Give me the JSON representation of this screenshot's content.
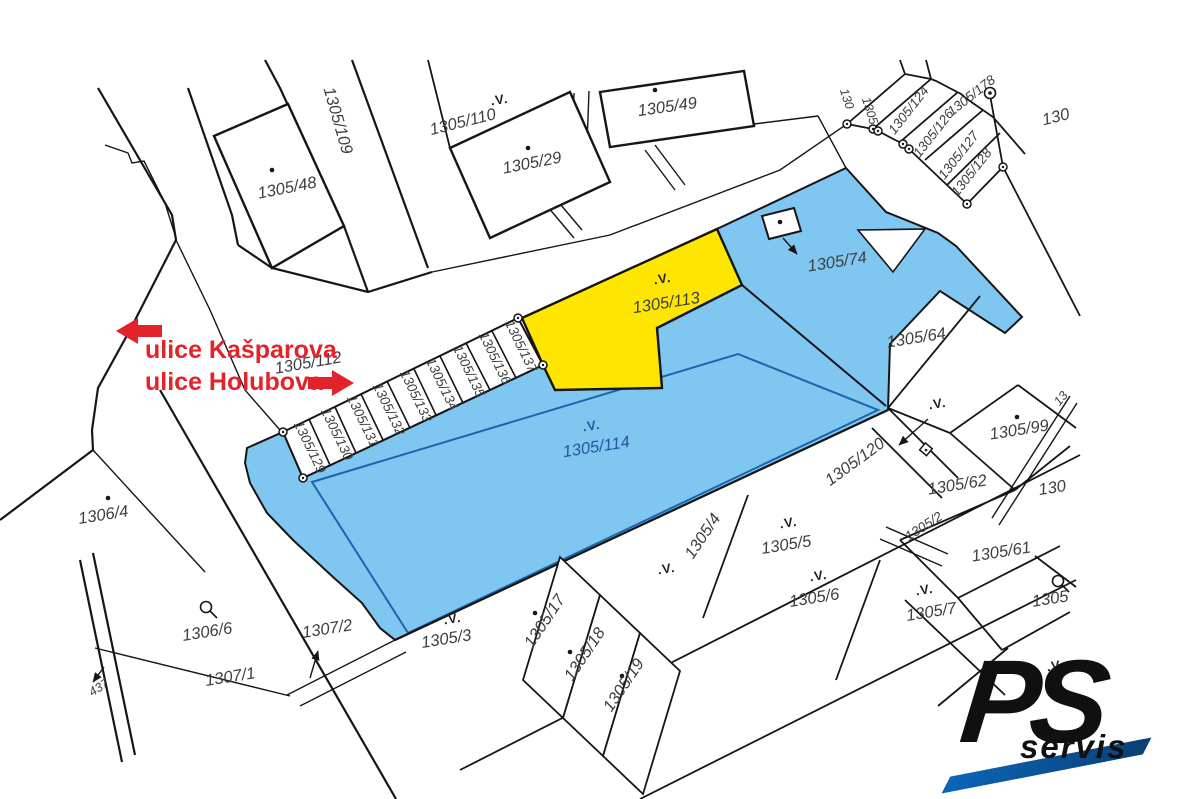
{
  "colors": {
    "parcel_blue": "#7fc6f1",
    "parcel_yellow": "#ffe600",
    "line": "#161616",
    "label": "#3f3f3f",
    "label_blue": "#2456a4",
    "red": "#e2242a",
    "logo_blue": "#0a66b8"
  },
  "street_annotations": {
    "kasparova": "ulice Kašparova",
    "holubova": "ulice Holubova"
  },
  "symbols": {
    "landuse": ".V."
  },
  "labels": [
    {
      "text": "1305/109"
    },
    {
      "text": "1305/110"
    },
    {
      "text": "1305/29"
    },
    {
      "text": "1305/49"
    },
    {
      "text": "1305/48"
    },
    {
      "text": "1305/112"
    },
    {
      "text": "1305/113"
    },
    {
      "text": "1305/74"
    },
    {
      "text": "1305/64"
    },
    {
      "text": "1305/114"
    },
    {
      "text": "1305/120"
    },
    {
      "text": "1305/99"
    },
    {
      "text": "1305/62"
    },
    {
      "text": "1305/61"
    },
    {
      "text": "1305/2"
    },
    {
      "text": "1306/4"
    },
    {
      "text": "1306/6"
    },
    {
      "text": "1307/2"
    },
    {
      "text": "1307/1"
    },
    {
      "text": "1305/3"
    },
    {
      "text": "1305/17"
    },
    {
      "text": "1305/18"
    },
    {
      "text": "1305/19"
    },
    {
      "text": "1305/4"
    },
    {
      "text": "1305/5"
    },
    {
      "text": "1305/6"
    },
    {
      "text": "1305/7"
    },
    {
      "text": "1305/129"
    },
    {
      "text": "1305/130"
    },
    {
      "text": "1305/131"
    },
    {
      "text": "1305/132"
    },
    {
      "text": "1305/133"
    },
    {
      "text": "1305/134"
    },
    {
      "text": "1305/135"
    },
    {
      "text": "1305/136"
    },
    {
      "text": "1305/137"
    },
    {
      "text": "1305/124"
    },
    {
      "text": "1305/126"
    },
    {
      "text": "1305/127"
    },
    {
      "text": "1305/128"
    },
    {
      "text": "1305/178"
    },
    {
      "text": "130"
    },
    {
      "text": "1305"
    },
    {
      "text": "130"
    },
    {
      "text": "13"
    },
    {
      "text": "130"
    },
    {
      "text": "1305"
    },
    {
      "text": "437"
    }
  ],
  "logo": {
    "ps": "PS",
    "servis": "servis"
  }
}
